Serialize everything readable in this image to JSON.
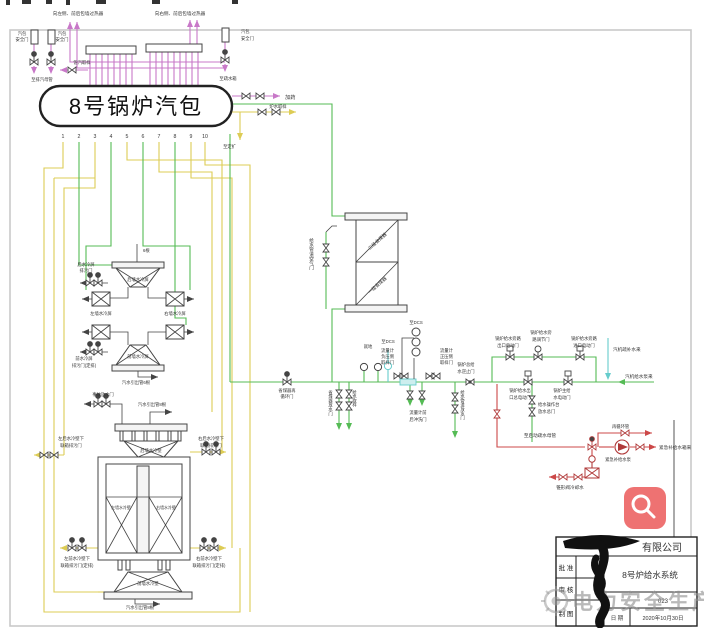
{
  "colors": {
    "purple": "#c878c8",
    "yellow": "#ddcc55",
    "green": "#55bb55",
    "teal": "#66cccc",
    "red": "#cc4848",
    "frame": "#c9c9c9",
    "button": "#ee7272"
  },
  "drum": {
    "title": "8号锅炉汽包",
    "numbers": [
      "1",
      "2",
      "3",
      "4",
      "5",
      "6",
      "7",
      "8",
      "9",
      "10"
    ]
  },
  "top": {
    "left_superheater": "向左侧、前后包墙过热器",
    "right_superheater": "向右侧、前后包墙过热器",
    "safety_valve_l1": [
      "汽包",
      "安全门"
    ],
    "safety_valve_l2": [
      "汽包",
      "安全门"
    ],
    "safety_valve_r": [
      "汽包",
      "安全门"
    ],
    "to_exhaust": "至排汽母管",
    "sat_sample": "饱汽取样",
    "to_drain_tank": "至疏水箱",
    "dosing": "加药",
    "water_sample": "炉水取样",
    "to_blowdown": "至定扩"
  },
  "screens": {
    "six": "6根",
    "rear": "后墙水冷屏",
    "left": "左墙水冷屏",
    "right": "右墙水冷屏",
    "front": "前墙水冷屏",
    "rear_blowdown": [
      "后水冷屏",
      "排污门"
    ],
    "front_blowdown": [
      "前水冷屏",
      "排污门(定排)"
    ],
    "outlet6": "汽水引出管6根"
  },
  "furnace": {
    "accident": "事故放水门",
    "outlet8_top": "汽水引出管8根",
    "outlet8_bottom": "汽水引出管8根",
    "rear": "后墙水冷壁",
    "front": "前墙水冷壁",
    "left": "左墙水冷壁",
    "right": "右墙水冷壁",
    "ul": [
      "左后水冷壁下",
      "联箱排污门"
    ],
    "ur": [
      "右后水冷壁下",
      "联箱排污门"
    ],
    "ll": [
      "左前水冷壁下",
      "联箱排污门(定排)"
    ],
    "lr": [
      "右前水冷壁下",
      "联箱排污门(定排)"
    ]
  },
  "economizer": {
    "stage2": "二级省煤器",
    "stage1": "一级省煤器",
    "air_valve": "给水管道空气门"
  },
  "feedline": {
    "recirc_valve": [
      "省煤器再",
      "循环门"
    ],
    "econ_drain": "省煤器放水门",
    "feed_sample": "给水取样",
    "local": "就地",
    "dcs1": "至DCS",
    "dcs2": "至DCS",
    "fm_neg": [
      "流量计",
      "负压侧",
      "取样门"
    ],
    "fm_pos": [
      "流量计",
      "正压侧",
      "取样门"
    ],
    "fm_flush": [
      "流量计前",
      "后冲洗门"
    ],
    "check": [
      "锅炉总给",
      "水逆止门"
    ],
    "pipe_drain": "给水管道放水门",
    "bypass_out": [
      "锅炉给水旁路",
      "出口电动门"
    ],
    "bypass_reg": [
      "锅炉给水旁",
      "路调节门"
    ],
    "bypass_in": [
      "锅炉给水旁路",
      "进口电动门"
    ],
    "main_out": [
      "锅炉给水出",
      "口总电动门"
    ],
    "main_valve": [
      "锅炉主给",
      "水电动门"
    ],
    "console_drain": [
      "给水操作台",
      "放水总门"
    ],
    "turbine_makeup": "汽机疏补水来",
    "turbine_pump": "汽机给水泵来"
  },
  "red_system": {
    "to_startup": "至启动疏水母管",
    "recirc_pipe": "再循环管",
    "emer_pump": "紧急补给水泵",
    "emer_tank": "紧急补给水箱来",
    "cone_cooling": "锥形阀冷却水"
  },
  "title_block": {
    "company_suffix": "有限公司",
    "approve": "批 准",
    "review": "审 核",
    "draft": "制 图",
    "system": "8号炉给水系统",
    "number": "023",
    "date_label": "日 期",
    "date": "2020年10月30日"
  },
  "watermark": {
    "text": "电力安全生产"
  },
  "zoom_button": {
    "icon": "magnifier"
  }
}
